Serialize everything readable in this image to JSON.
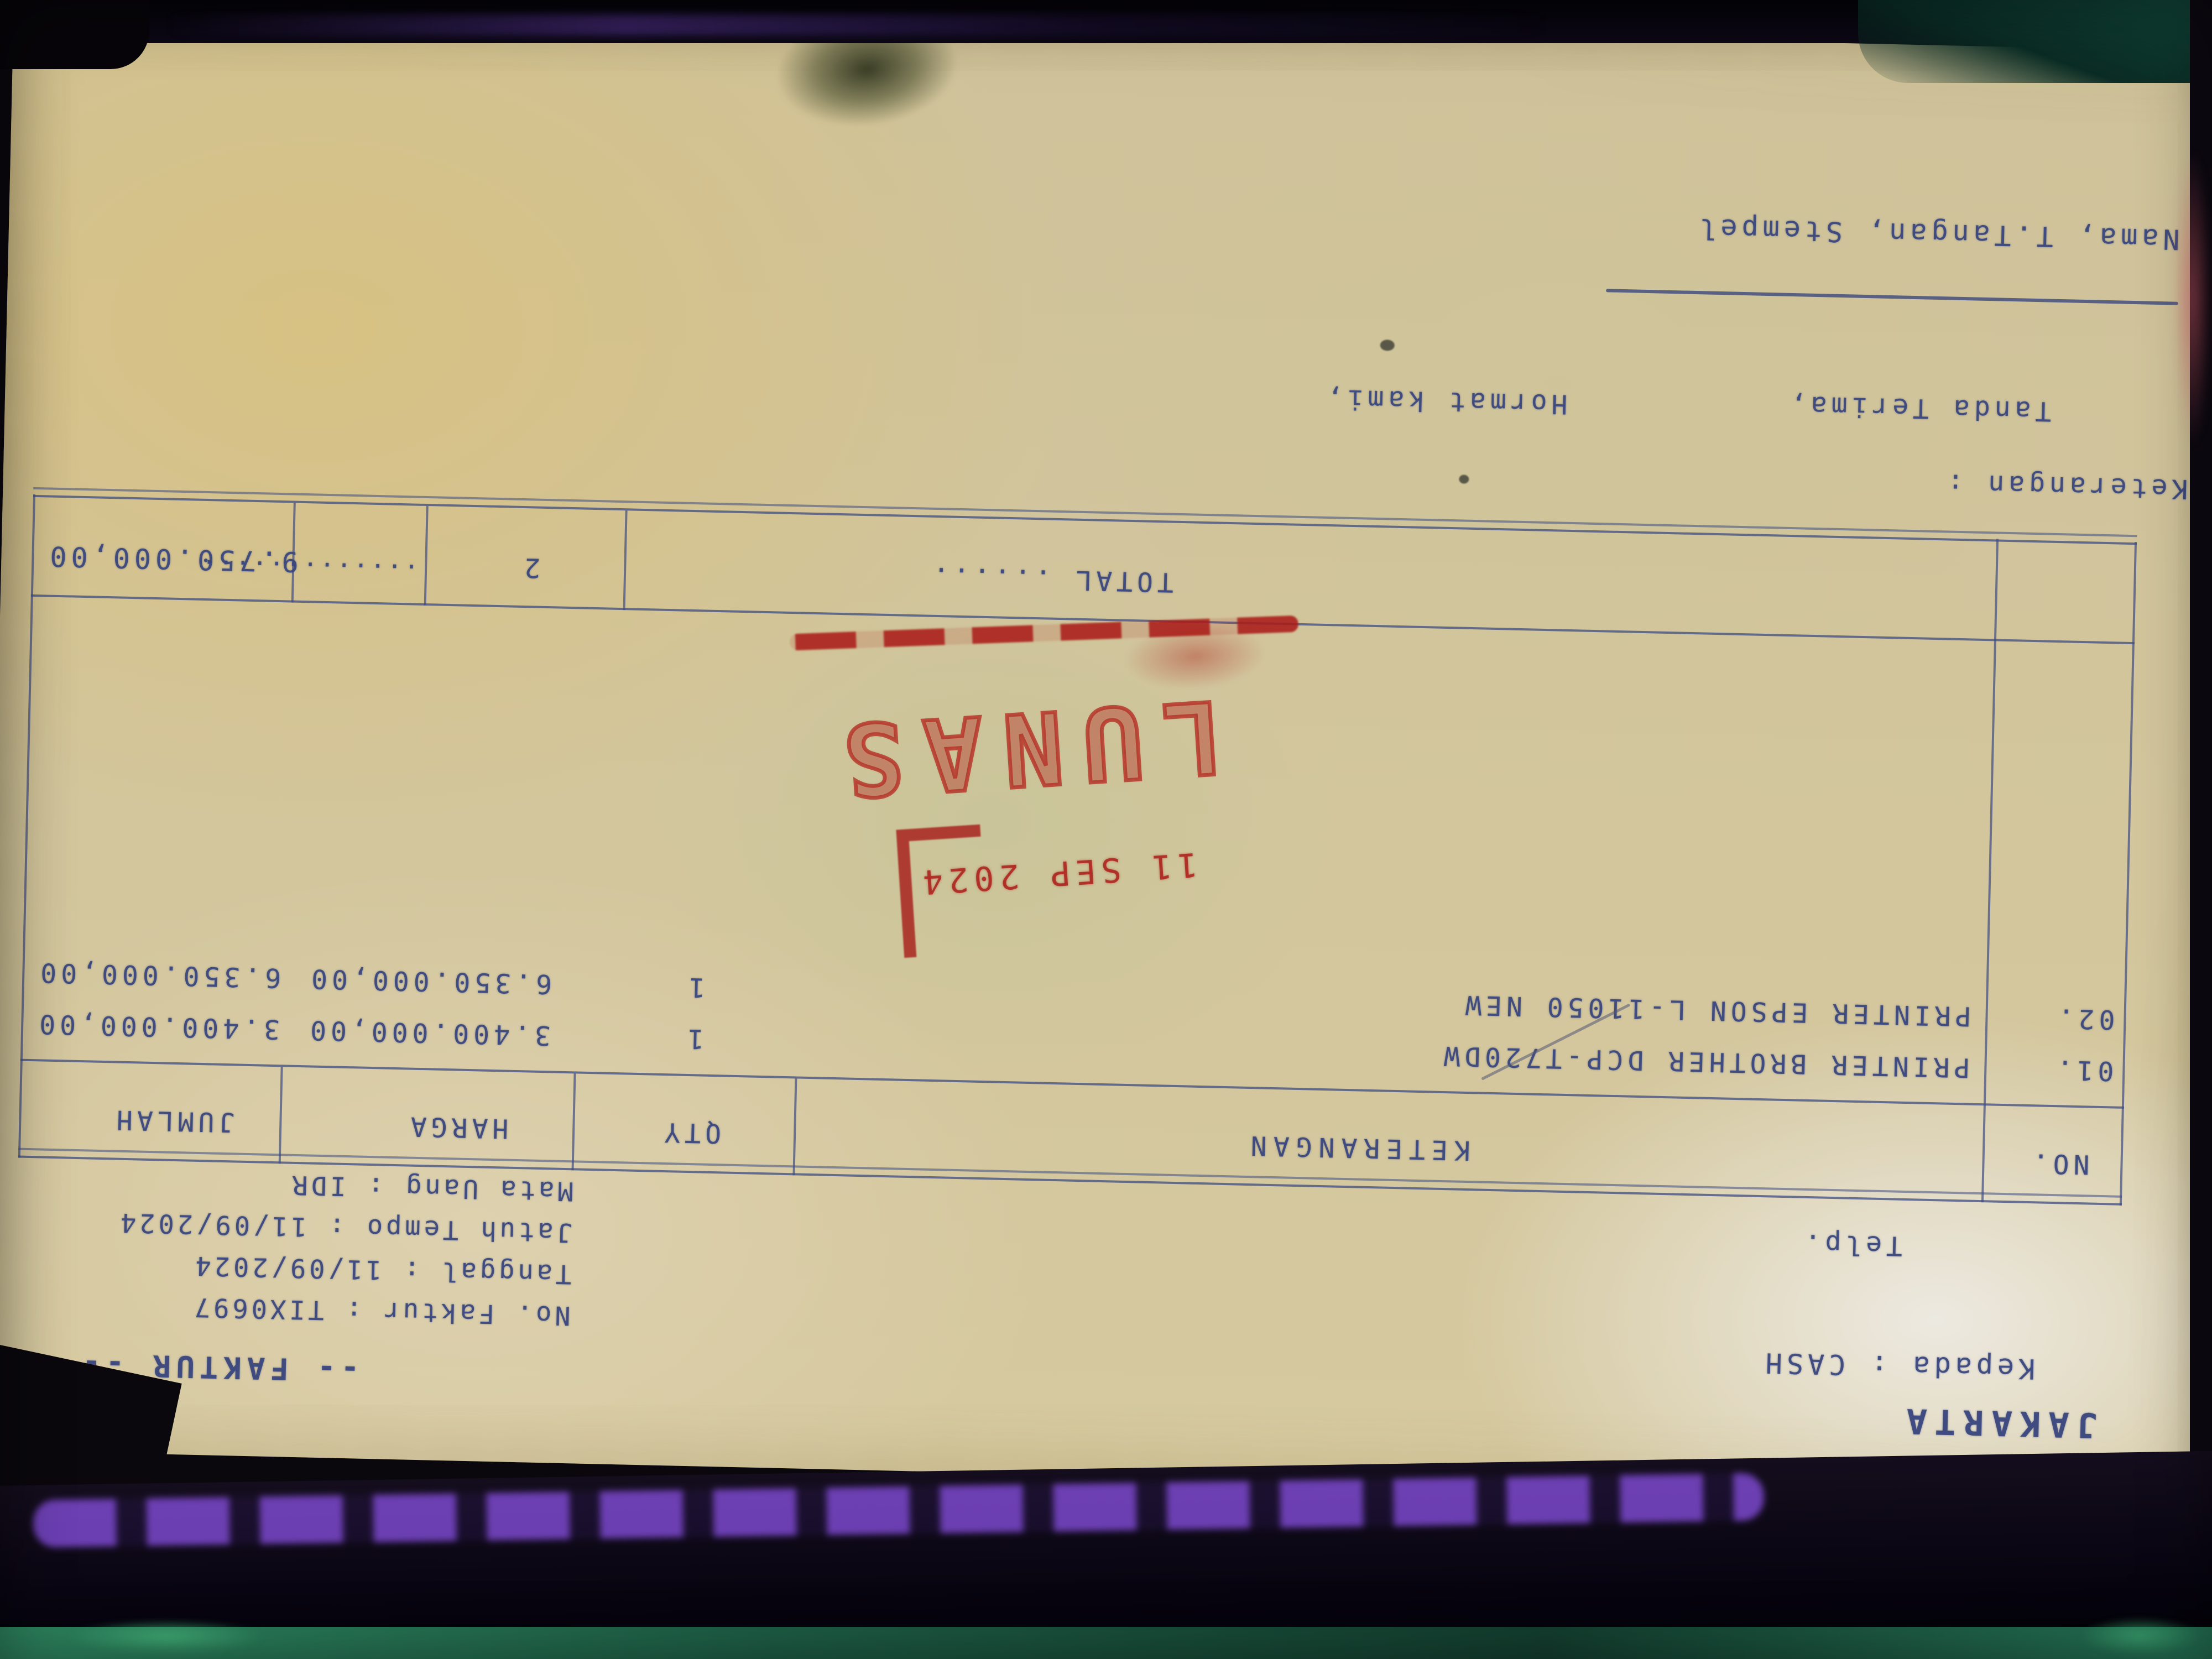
{
  "doc": {
    "header": {
      "city": "JAKARTA",
      "kepada": "Kepada : CASH",
      "telp": "Telp.",
      "title": "-- FAKTUR --",
      "meta_lines": [
        "No. Faktur : TIX0697",
        "Tanggal : 11/09/2024",
        "Jatuh Tempo : 11/09/2024",
        "Mata Uang : IDR"
      ]
    },
    "table": {
      "headers": [
        "NO.",
        "KETERANGAN",
        "QTY",
        "HARGA",
        "JUMLAH"
      ],
      "rows": [
        {
          "no": "01.",
          "keterangan": "PRINTER BROTHER DCP-T720DW",
          "qty": "1",
          "harga": "3.400.000,00",
          "jumlah": "3.400.000,00"
        },
        {
          "no": "02.",
          "keterangan": "PRINTER EPSON L-11050 NEW",
          "qty": "1",
          "harga": "6.350.000,00",
          "jumlah": "6.350.000,00"
        }
      ],
      "total": {
        "label": "TOTAL ......",
        "qty": "2",
        "harga_dots": ".............",
        "jumlah": "9.750.000,00"
      }
    },
    "footer": {
      "keterangan_label": "Keterangan :",
      "tanda_terima": "Tanda Terima,",
      "hormat_kami": "Hormat kami,",
      "nama_line": "Nama, T.Tangan, Stempel"
    },
    "stamp": {
      "word": "LUNAS",
      "date": "11 SEP 2024"
    },
    "colors": {
      "ink": "#39477e",
      "stamp_red": "#b3231c",
      "paper": "#d5c89e"
    }
  }
}
